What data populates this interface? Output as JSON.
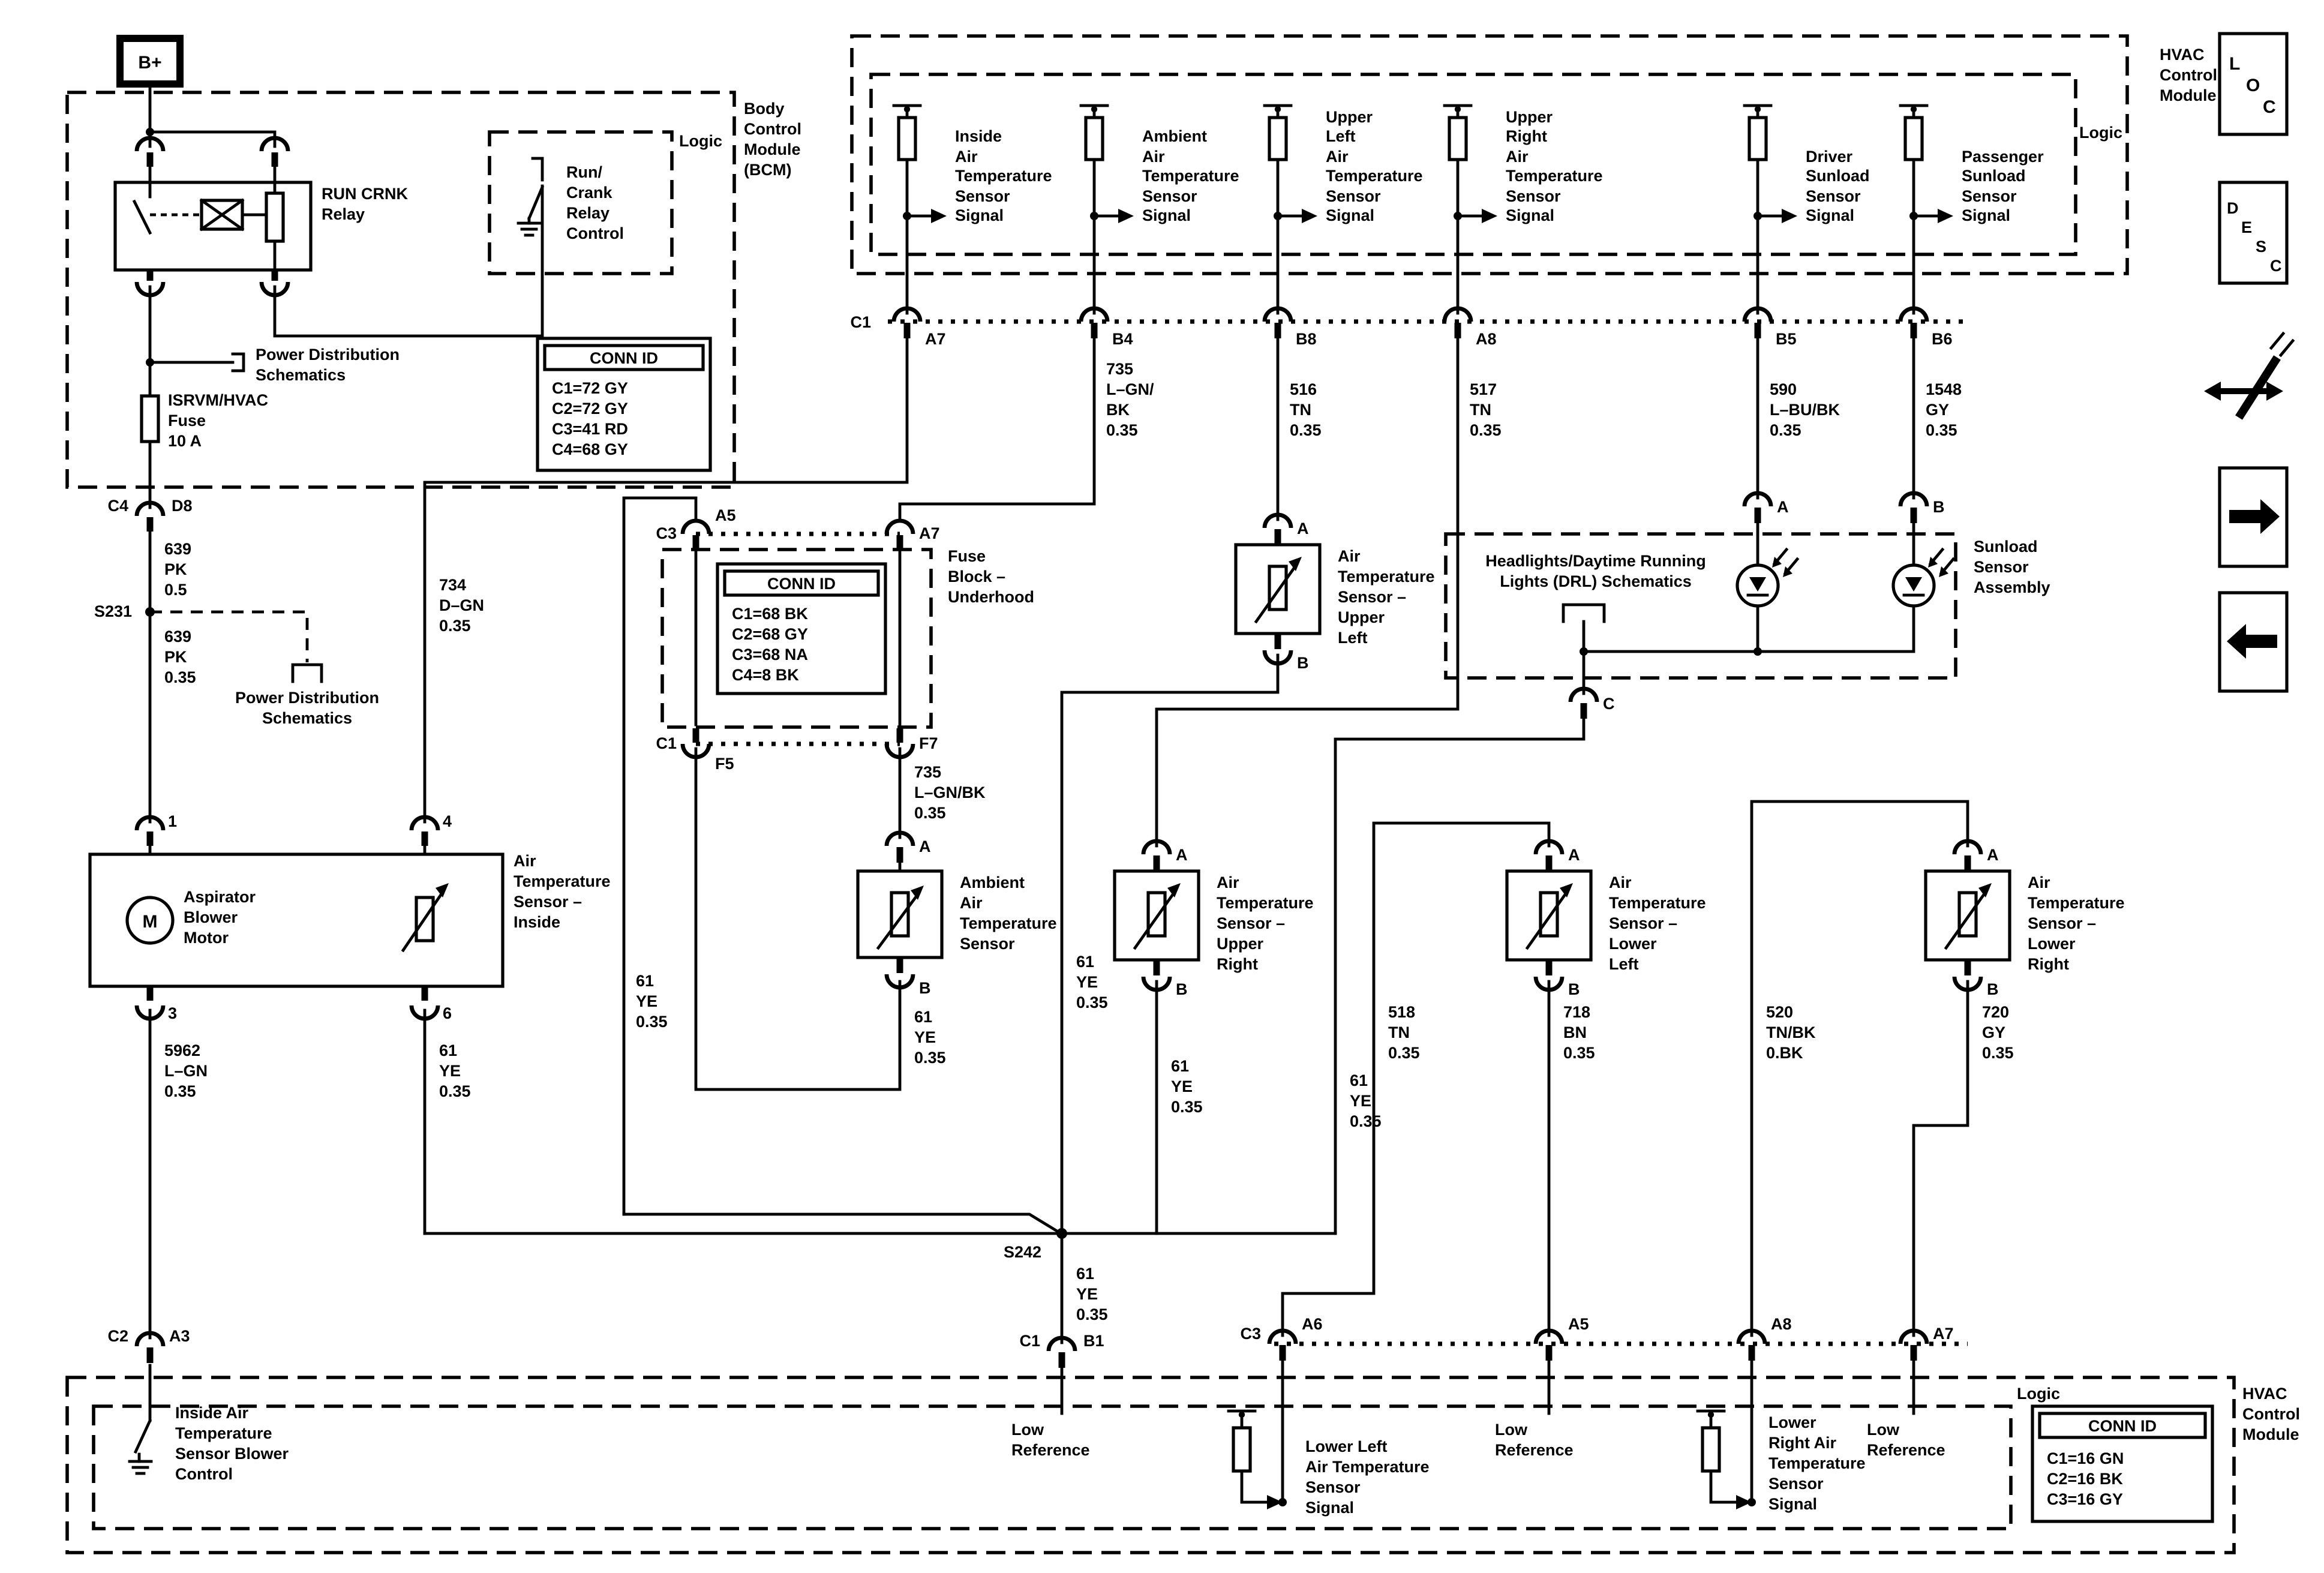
{
  "bplus": {
    "label": "B+"
  },
  "bcm": {
    "name_lines": [
      "Body",
      "Control",
      "Module",
      "(BCM)"
    ],
    "logic": "Logic",
    "relay": {
      "name1": "RUN CRNK",
      "name2": "Relay"
    },
    "run_crank": [
      "Run/",
      "Crank",
      "Relay",
      "Control"
    ],
    "fuse": [
      "ISRVM/HVAC",
      "Fuse",
      "10 A"
    ],
    "conn_id": {
      "header": "CONN ID",
      "rows": [
        "C1=72 GY",
        "C2=72 GY",
        "C3=41 RD",
        "C4=68 GY"
      ]
    },
    "conn_out": {
      "left": "C4",
      "right": "D8"
    }
  },
  "power_dist": [
    "Power Distribution",
    "Schematics"
  ],
  "splices": {
    "s231": "S231",
    "s242": "S242"
  },
  "low_ref": [
    "Low",
    "Reference"
  ],
  "w61": [
    "61",
    "YE",
    "0.35"
  ],
  "wires": {
    "w639a": [
      "639",
      "PK",
      "0.5"
    ],
    "w639b": [
      "639",
      "PK",
      "0.35"
    ],
    "w734": [
      "734",
      "D–GN",
      "0.35"
    ],
    "w5962": [
      "5962",
      "L–GN",
      "0.35"
    ],
    "w735a": [
      "735",
      "L–GN/",
      "BK",
      "0.35"
    ],
    "w516": [
      "516",
      "TN",
      "0.35"
    ],
    "w517": [
      "517",
      "TN",
      "0.35"
    ],
    "w590": [
      "590",
      "L–BU/BK",
      "0.35"
    ],
    "w1548": [
      "1548",
      "GY",
      "0.35"
    ],
    "w735b": [
      "735",
      "L–GN/BK",
      "0.35"
    ],
    "w518": [
      "518",
      "TN",
      "0.35"
    ],
    "w718": [
      "718",
      "BN",
      "0.35"
    ],
    "w520": [
      "520",
      "TN/BK",
      "0.BK"
    ],
    "w720": [
      "720",
      "GY",
      "0.35"
    ]
  },
  "top_module": {
    "name_lines": [
      "HVAC",
      "Control",
      "Module"
    ],
    "logic": "Logic",
    "row_label": "C1",
    "sensors": [
      {
        "lines": [
          "Inside",
          "Air",
          "Temperature",
          "Sensor",
          "Signal"
        ],
        "pin": "A7"
      },
      {
        "lines": [
          "Ambient",
          "Air",
          "Temperature",
          "Sensor",
          "Signal"
        ],
        "pin": "B4"
      },
      {
        "lines": [
          "Upper",
          "Left",
          "Air",
          "Temperature",
          "Sensor",
          "Signal"
        ],
        "pin": "B8"
      },
      {
        "lines": [
          "Upper",
          "Right",
          "Air",
          "Temperature",
          "Sensor",
          "Signal"
        ],
        "pin": "A8"
      },
      {
        "lines": [
          "Driver",
          "Sunload",
          "Sensor",
          "Signal"
        ],
        "pin": "B5"
      },
      {
        "lines": [
          "Passenger",
          "Sunload",
          "Sensor",
          "Signal"
        ],
        "pin": "B6"
      }
    ]
  },
  "fuse_block": {
    "name_lines": [
      "Fuse",
      "Block –",
      "Underhood"
    ],
    "conn_id": {
      "header": "CONN ID",
      "rows": [
        "C1=68 BK",
        "C2=68 GY",
        "C3=68 NA",
        "C4=8 BK"
      ]
    },
    "pins": {
      "c3": "C3",
      "a5": "A5",
      "a7": "A7",
      "c1": "C1",
      "f5": "F5",
      "f7": "F7"
    }
  },
  "ambient": {
    "lines": [
      "Ambient",
      "Air",
      "Temperature",
      "Sensor"
    ],
    "a": "A",
    "b": "B"
  },
  "inside_sensor": {
    "lines": [
      "Air",
      "Temperature",
      "Sensor –",
      "Inside"
    ]
  },
  "aspirator": {
    "lines": [
      "Aspirator",
      "Blower",
      "Motor"
    ],
    "motor": "M",
    "pins": {
      "p1": "1",
      "p3": "3",
      "p4": "4",
      "p6": "6"
    }
  },
  "ul_sensor": {
    "lines": [
      "Air",
      "Temperature",
      "Sensor –",
      "Upper",
      "Left"
    ],
    "a": "A",
    "b": "B"
  },
  "ur_sensor": {
    "lines": [
      "Air",
      "Temperature",
      "Sensor –",
      "Upper",
      "Right"
    ],
    "a": "A",
    "b": "B"
  },
  "ll_sensor": {
    "lines": [
      "Air",
      "Temperature",
      "Sensor –",
      "Lower",
      "Left"
    ],
    "a": "A",
    "b": "B"
  },
  "lr_sensor": {
    "lines": [
      "Air",
      "Temperature",
      "Sensor –",
      "Lower",
      "Right"
    ],
    "a": "A",
    "b": "B"
  },
  "drl": {
    "box_lines": [
      "Headlights/Daytime Running",
      "Lights (DRL) Schematics"
    ],
    "sunload_lines": [
      "Sunload",
      "Sensor",
      "Assembly"
    ],
    "a": "A",
    "b": "B",
    "c": "C"
  },
  "bottom_module": {
    "name_lines": [
      "HVAC",
      "Control",
      "Module"
    ],
    "logic": "Logic",
    "conn_id": {
      "header": "CONN ID",
      "rows": [
        "C1=16 GN",
        "C2=16 BK",
        "C3=16 GY"
      ]
    },
    "inside_ctrl": [
      "Inside Air",
      "Temperature",
      "Sensor Blower",
      "Control"
    ],
    "ll_signal": [
      "Lower Left",
      "Air Temperature",
      "Sensor",
      "Signal"
    ],
    "lr_signal": [
      "Lower",
      "Right Air",
      "Temperature",
      "Sensor",
      "Signal"
    ],
    "pins": {
      "c2": "C2",
      "a3": "A3",
      "c1": "C1",
      "b1": "B1",
      "c3": "C3",
      "a6": "A6",
      "a5": "A5",
      "a8": "A8",
      "a7": "A7"
    }
  },
  "nav": {
    "loc": [
      "L",
      "O",
      "C"
    ],
    "desc": [
      "D",
      "E",
      "S",
      "C"
    ]
  }
}
